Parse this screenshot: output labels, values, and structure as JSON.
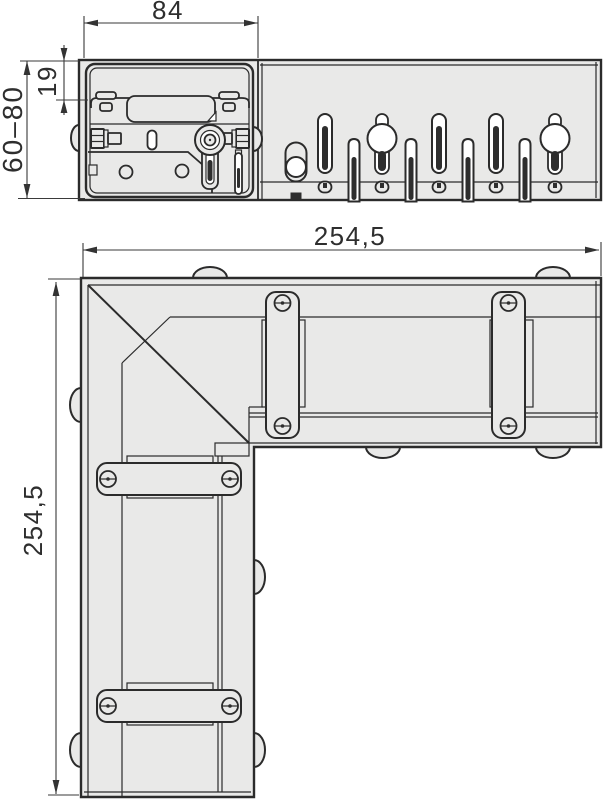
{
  "drawing": {
    "type": "technical-drawing",
    "subject": "corner-drainage-channel-unit",
    "colors": {
      "line": "#2b2b2b",
      "surface": "#e9e9e8",
      "hole": "#ffffff",
      "slot_dark": "#2e2e2e",
      "background": "#ffffff",
      "text": "#2e2e2e"
    },
    "side_view": {
      "label": "side-elevation",
      "dim_width": "84",
      "dim_flange_height": "19",
      "dim_height_range": "60–80"
    },
    "plan_view": {
      "label": "plan-view",
      "dim_length_horizontal": "254,5",
      "dim_length_vertical": "254,5"
    }
  }
}
